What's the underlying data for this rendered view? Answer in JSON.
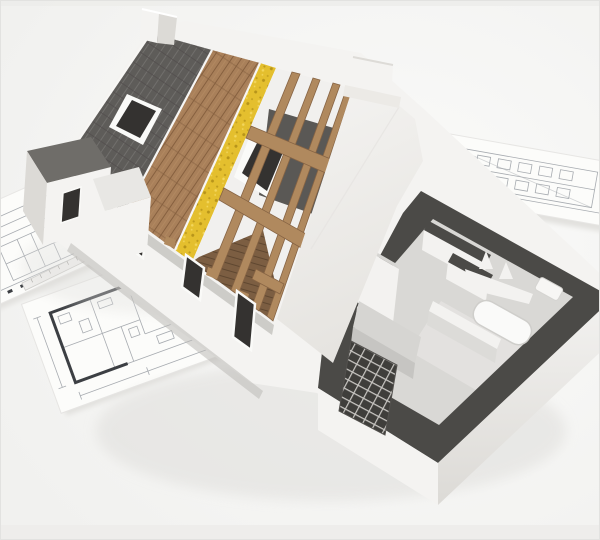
{
  "scene": {
    "description": "3D isometric rendering of a cutaway house model under construction resting on architectural blueprint sheets",
    "style": "photorealistic architectural visualization, white background",
    "components": [
      "asphalt-shingle roof layer",
      "wood decking roof layer",
      "yellow insulation roof layer",
      "exposed timber rafters",
      "skylight opening",
      "attic window opening",
      "ridge chimney",
      "gable chimney",
      "white gable wall",
      "front facade with window openings",
      "ground-floor cutaway with dark cut wall tops",
      "interior partitions",
      "kitchen counters",
      "brick chimney base",
      "bathtub",
      "blueprint floor plan sheets",
      "elevation drawing sheet",
      "scale ruler"
    ]
  },
  "colors": {
    "background_edge": "#f1f1ef",
    "background_center": "#fbfbfa",
    "paper": "#fcfcfa",
    "paper_shadow": "#e2e1de",
    "blueprint_line": "#a7abb0",
    "blueprint_wall": "#3c3f43",
    "shingle": "#5e5c59",
    "shingle_line": "#716f6c",
    "deck_wood": "#a9805a",
    "deck_line": "#86603f",
    "deck_grain": "#c29a6e",
    "insulation": "#e4bf2e",
    "insulation_speck": "#b7941a",
    "insulation_light": "#f3d65c",
    "batten": "#f7f6f4",
    "rafter": "#b0895e",
    "rafter_edge": "#876444",
    "attic_wall": "#5a5855",
    "attic_floor": "#7c5e42",
    "attic_floor_line": "#5f4730",
    "wall_white": "#f4f3f1",
    "wall_shade": "#dcdad6",
    "gable_low": "#e6e4e0",
    "window_dark": "#343230",
    "window_frame": "#fafaf8",
    "eave_shadow": "#bcbab7",
    "cut_wall": "#4b4a47",
    "floor": "#d9d8d5",
    "floor_light": "#e4e3e0",
    "inner_wall": "#f3f2f0",
    "inner_wall_side": "#dcdbd8",
    "counter": "#c6c5c2",
    "counter_top": "#d6d5d2",
    "brick_dark": "#3f3e3b",
    "brick_line": "#c8c6c2",
    "wing_roof": "#6f6d69",
    "shadow": "#dfdedb"
  }
}
